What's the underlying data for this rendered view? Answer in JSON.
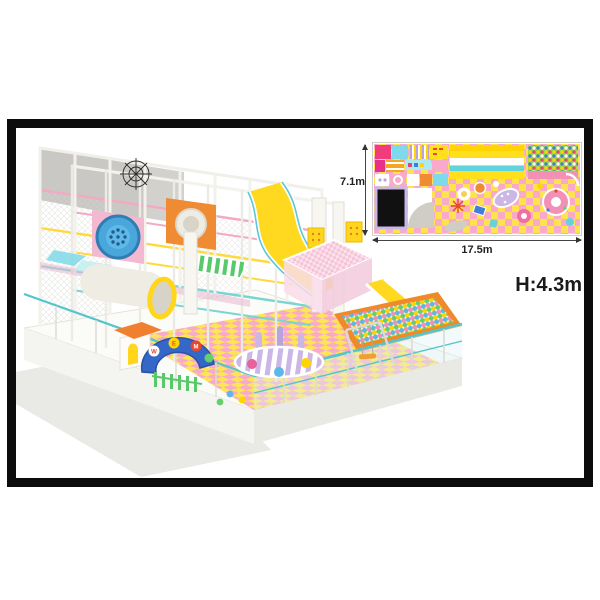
{
  "annotations": {
    "depth_label": "7.1m",
    "width_label": "17.5m",
    "height_label": "H:4.3m"
  },
  "render": {
    "arch_letters": [
      "W",
      "E",
      "M"
    ]
  },
  "palette": {
    "frame_border": "#0c0c0c",
    "floor_pink": "#f7a6c8",
    "floor_yellow": "#ffe34d",
    "rail_pink": "#f3a8c6",
    "rail_yellow": "#ffd83a",
    "rail_cyan": "#79d4d4",
    "slide_yellow": "#ffd91f",
    "ball_pit_rim": "#ef8a2a",
    "roof_pink": "#f6c3d6",
    "arch_blue": "#3567c8",
    "plan_ball_pit_green": "#8fd34f",
    "plan_trampoline_black": "#111111"
  }
}
